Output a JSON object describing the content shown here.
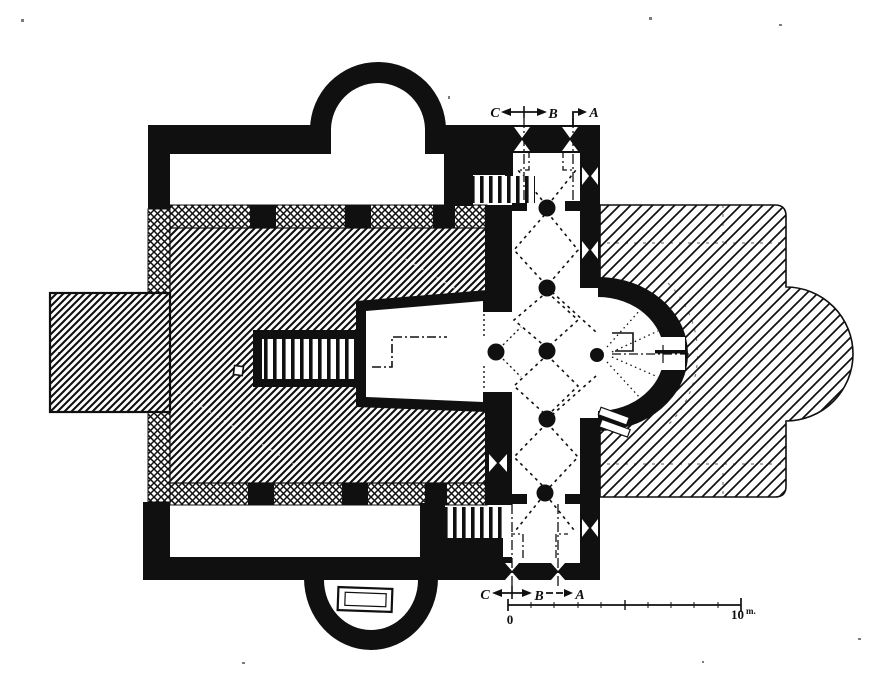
{
  "plan": {
    "ink_color": "#101010",
    "paper_color": "#ffffff",
    "description": "church-floor-plan"
  },
  "section_markers": {
    "top": {
      "c": "C",
      "b": "B",
      "a": "A"
    },
    "bottom": {
      "c": "C",
      "b": "B",
      "a": "A"
    }
  },
  "scale_bar": {
    "start_label": "0",
    "end_value": "10",
    "end_unit": "m."
  }
}
